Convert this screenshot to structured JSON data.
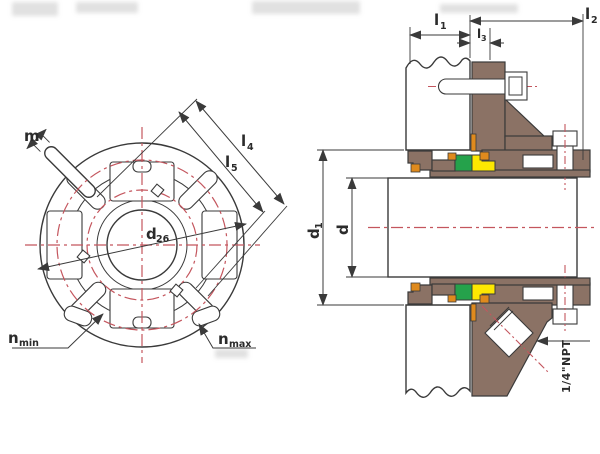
{
  "drawing": {
    "front_view": {
      "labels": {
        "m": {
          "base": "m"
        },
        "l4": {
          "base": "l",
          "sub": "4"
        },
        "l5": {
          "base": "l",
          "sub": "5"
        },
        "d26": {
          "base": "d",
          "sub": "26"
        },
        "n_min": {
          "base": "n",
          "sub": "min"
        },
        "n_max": {
          "base": "n",
          "sub": "max"
        }
      }
    },
    "section_view": {
      "labels": {
        "l1": {
          "base": "l",
          "sub": "1"
        },
        "l2": {
          "base": "l",
          "sub": "2"
        },
        "l3": {
          "base": "l",
          "sub": "3"
        },
        "d1": {
          "base": "d",
          "sub": "1"
        },
        "d": {
          "base": "d"
        },
        "npt": "1/4\"NPT"
      }
    }
  },
  "colors": {
    "line": "#3a3a3a",
    "centerline_red": "#c4565e",
    "part_brown": "#8b7265",
    "part_green": "#25a24b",
    "part_yellow": "#fde801",
    "part_orange": "#df8a1d",
    "background": "#ffffff"
  }
}
